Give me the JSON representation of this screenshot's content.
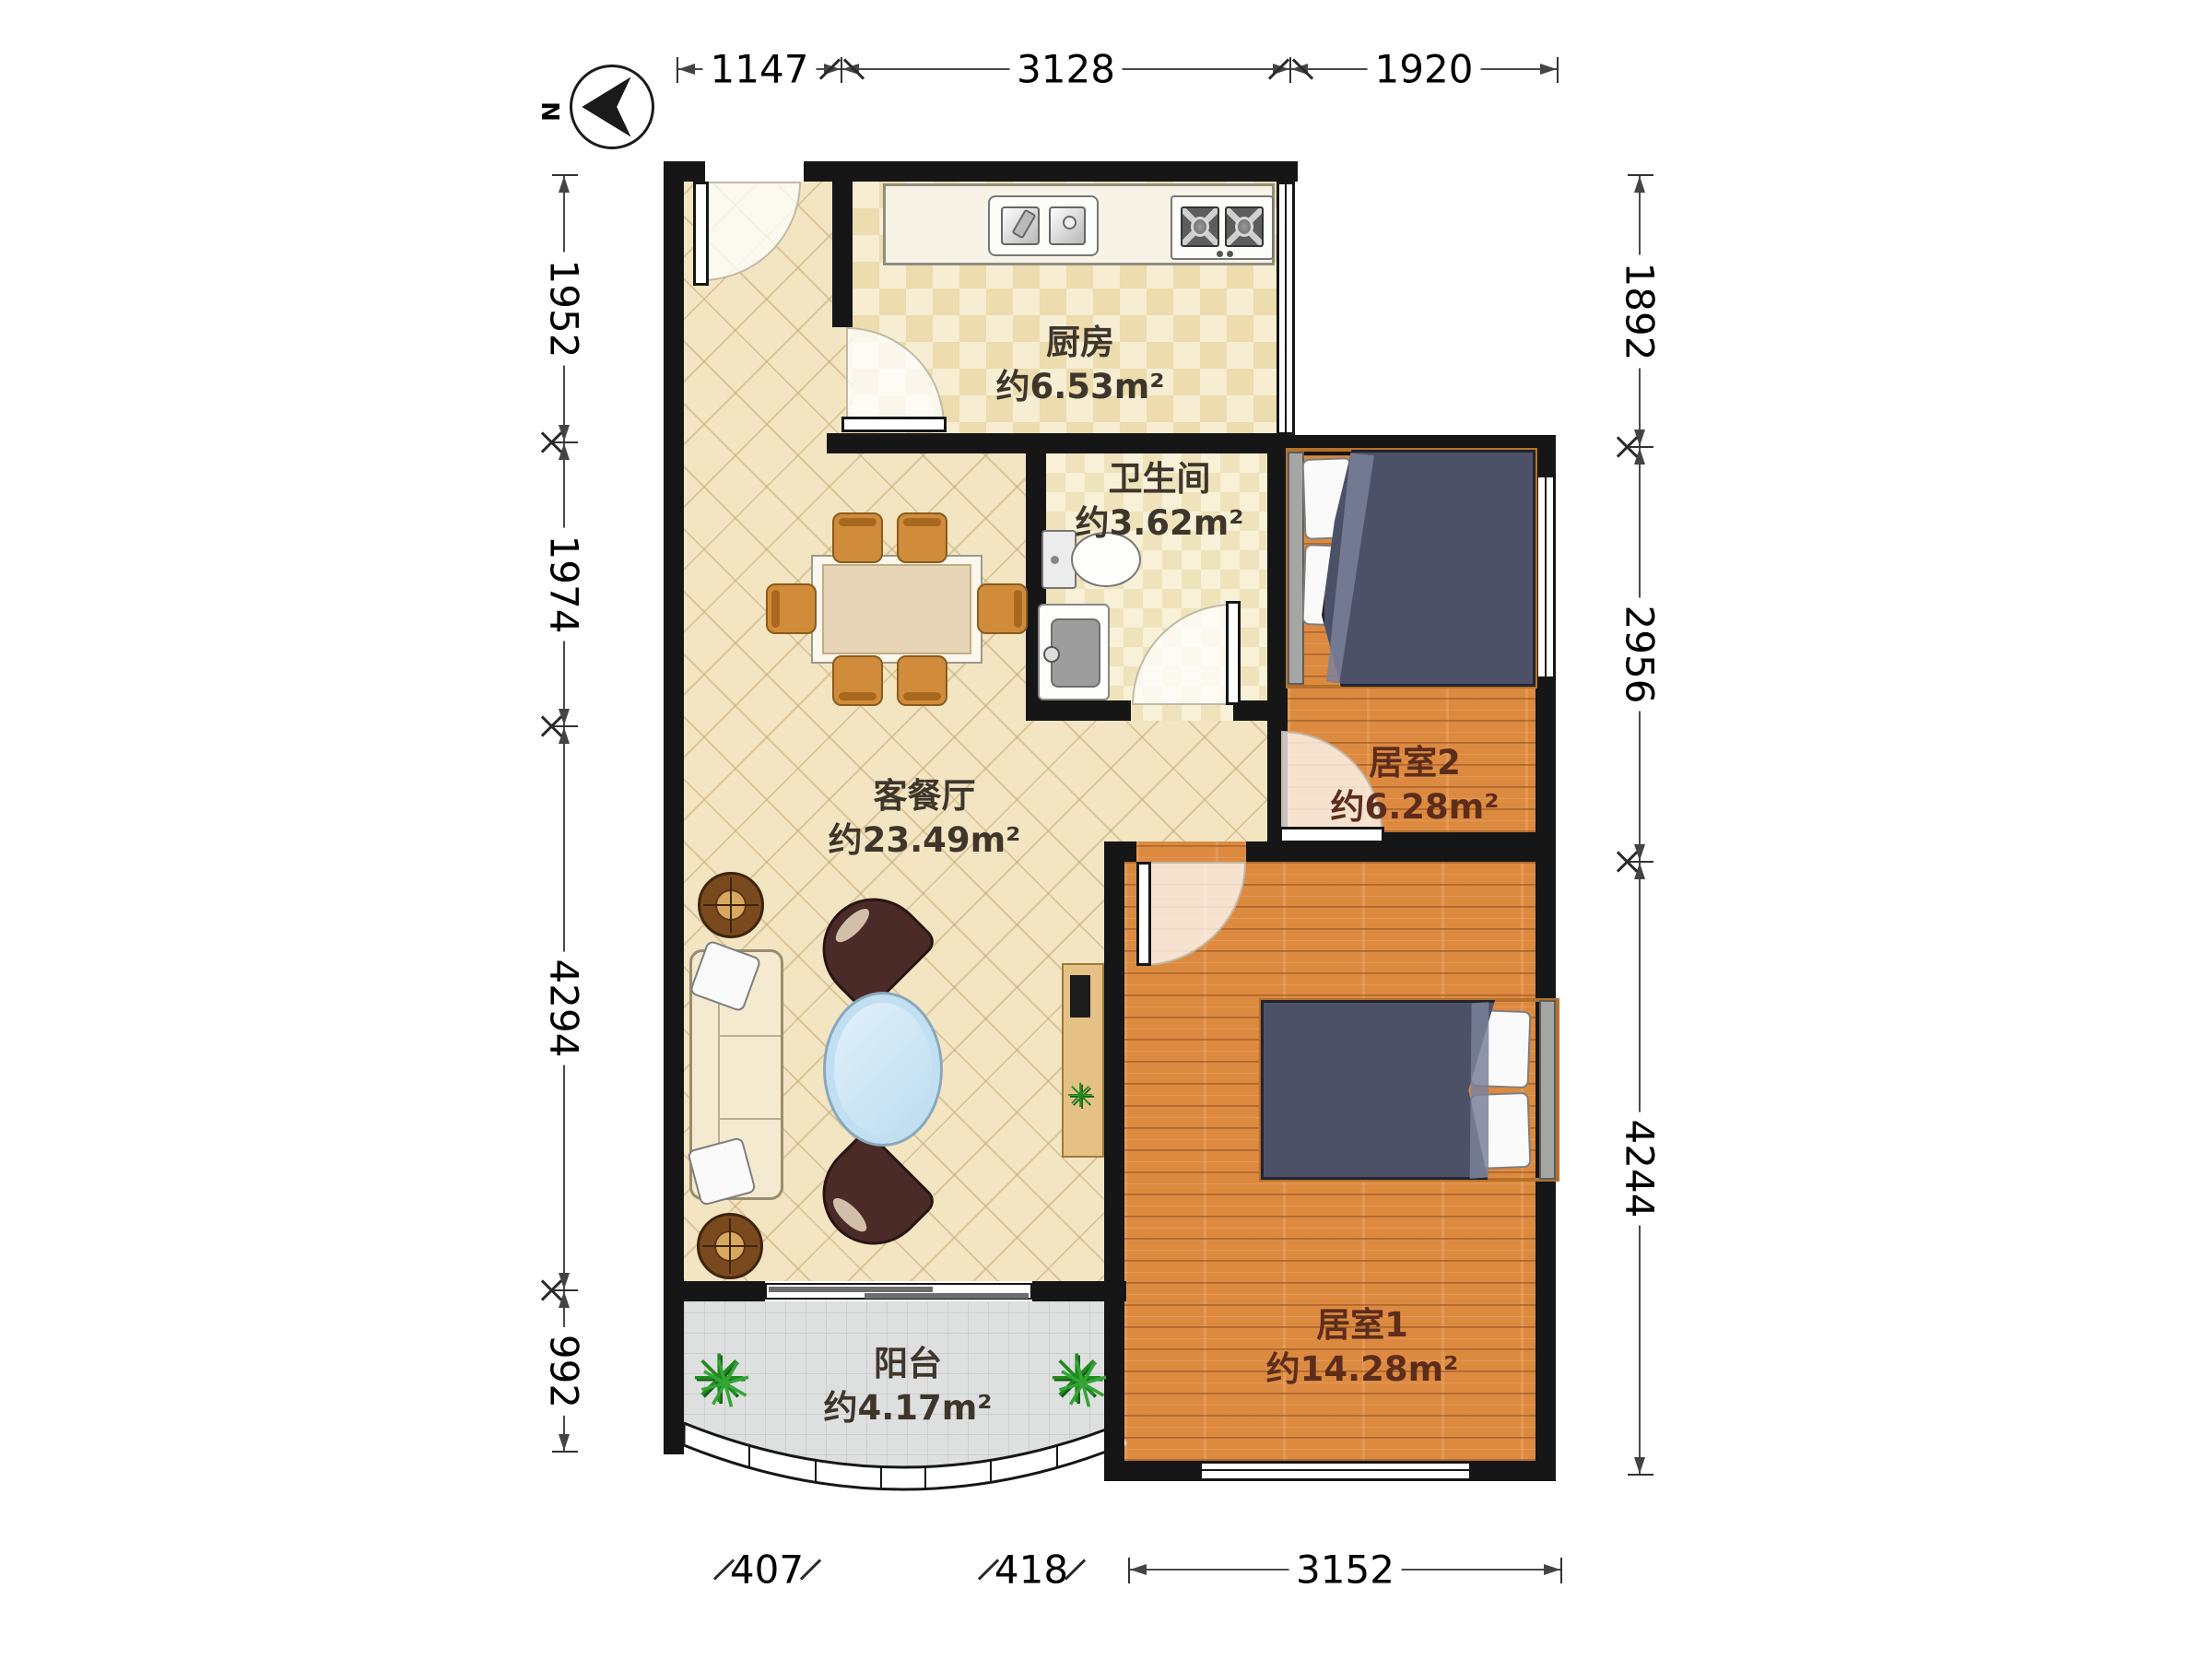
{
  "compass": {
    "label": "N"
  },
  "rooms": [
    {
      "name": "厨房",
      "area": "约6.53m²"
    },
    {
      "name": "卫生间",
      "area": "约3.62m²"
    },
    {
      "name": "客餐厅",
      "area": "约23.49m²"
    },
    {
      "name": "居室2",
      "area": "约6.28m²"
    },
    {
      "name": "居室1",
      "area": "约14.28m²"
    },
    {
      "name": "阳台",
      "area": "约4.17m²"
    }
  ],
  "dimensions": {
    "top": [
      "1147",
      "3128",
      "1920"
    ],
    "bottom": [
      "407",
      "418",
      "3152"
    ],
    "left": [
      "1952",
      "1974",
      "4294",
      "992"
    ],
    "right": [
      "1892",
      "2956",
      "4244"
    ]
  },
  "icons": {
    "plant": "✳"
  }
}
